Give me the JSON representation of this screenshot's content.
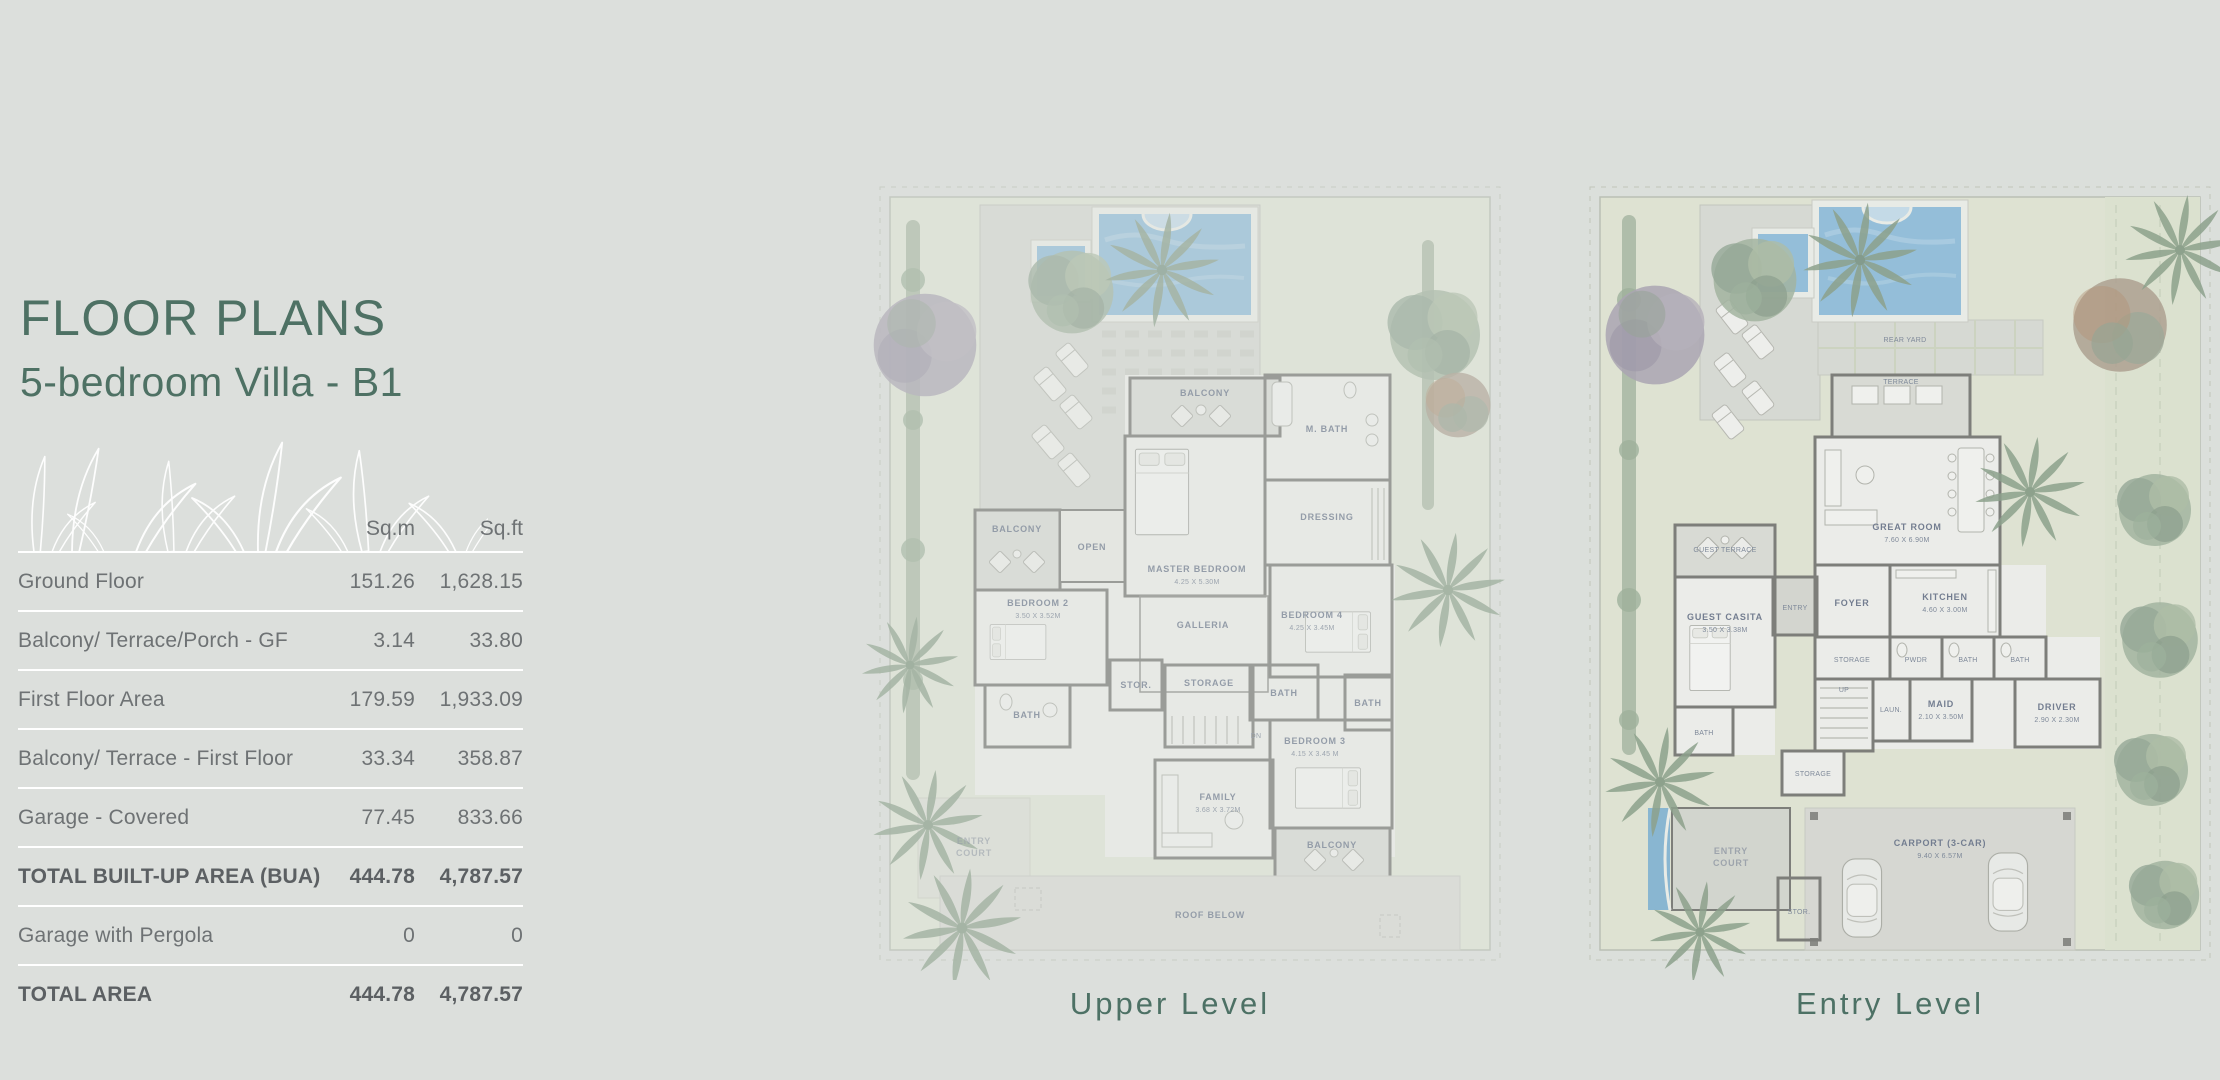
{
  "header": {
    "title": "FLOOR PLANS",
    "subtitle": "5-bedroom Villa - B1"
  },
  "table": {
    "columns": {
      "sqm": "Sq.m",
      "sqft": "Sq.ft"
    },
    "rows": [
      {
        "label": "Ground Floor",
        "sqm": "151.26",
        "sqft": "1,628.15",
        "bold": false
      },
      {
        "label": "Balcony/ Terrace/Porch - GF",
        "sqm": "3.14",
        "sqft": "33.80",
        "bold": false
      },
      {
        "label": "First Floor Area",
        "sqm": "179.59",
        "sqft": "1,933.09",
        "bold": false
      },
      {
        "label": "Balcony/ Terrace - First Floor",
        "sqm": "33.34",
        "sqft": "358.87",
        "bold": false
      },
      {
        "label": "Garage - Covered",
        "sqm": "77.45",
        "sqft": "833.66",
        "bold": false
      },
      {
        "label": "TOTAL BUILT-UP AREA (BUA)",
        "sqm": "444.78",
        "sqft": "4,787.57",
        "bold": true
      },
      {
        "label": "Garage with Pergola",
        "sqm": "0",
        "sqft": "0",
        "bold": false
      },
      {
        "label": "TOTAL AREA",
        "sqm": "444.78",
        "sqft": "4,787.57",
        "bold": true
      }
    ]
  },
  "plans": {
    "upper": {
      "caption": "Upper Level",
      "labels": {
        "balcony_top": "BALCONY",
        "m_bath": "M. BATH",
        "dressing": "DRESSING",
        "master": "MASTER BEDROOM",
        "master_dim": "4.25 X 5.30M",
        "balcony_left": "BALCONY",
        "open": "OPEN",
        "bedroom2": "BEDROOM 2",
        "bedroom2_dim": "3.50 X 3.52M",
        "galleria": "GALLERIA",
        "stor": "STOR.",
        "storage": "STORAGE",
        "dn": "DN",
        "bedroom4": "BEDROOM 4",
        "bedroom4_dim": "4.25 X 3.45M",
        "bath_left": "BATH",
        "bath_mid": "BATH",
        "bath_right": "BATH",
        "bedroom3": "BEDROOM 3",
        "bedroom3_dim": "4.15 X 3.45 M",
        "family": "FAMILY",
        "family_dim": "3.68 X 3.72M",
        "balcony_bottom": "BALCONY",
        "entry_court_line1": "ENTRY",
        "entry_court_line2": "COURT",
        "roof_below": "ROOF BELOW"
      }
    },
    "entry": {
      "caption": "Entry Level",
      "labels": {
        "rear_yard": "REAR YARD",
        "terrace": "TERRACE",
        "great_room": "GREAT ROOM",
        "great_room_dim": "7.60 X 6.90M",
        "kitchen": "KITCHEN",
        "kitchen_dim": "4.60 X 3.00M",
        "guest_terrace": "GUEST TERRACE",
        "guest_casita": "GUEST CASITA",
        "guest_casita_dim": "3.50 X 3.38M",
        "bath_casita": "BATH",
        "entry": "ENTRY",
        "foyer": "FOYER",
        "pwdr": "PWDR",
        "bath1": "BATH",
        "bath2": "BATH",
        "maid": "MAID",
        "maid_dim": "2.10 X 3.50M",
        "driver": "DRIVER",
        "driver_dim": "2.90 X 2.30M",
        "storage1": "STORAGE",
        "storage2": "STORAGE",
        "laun": "LAUN.",
        "up": "UP",
        "entry_court_line1": "ENTRY",
        "entry_court_line2": "COURT",
        "carport": "CARPORT (3-CAR)",
        "carport_dim": "9.40 X 6.57M",
        "stor": "STOR."
      }
    }
  },
  "colors": {
    "background": "#dcdfdc",
    "accent_green": "#4e7164",
    "table_text": "#6e7274",
    "table_text_bold": "#5c6063",
    "separator": "#ffffff",
    "plan_label": "#4b5874",
    "pool_water": "#7ab2d8",
    "lawn": "#e1e6d4",
    "paving": "#d5d7d0",
    "wall": "#595955"
  }
}
